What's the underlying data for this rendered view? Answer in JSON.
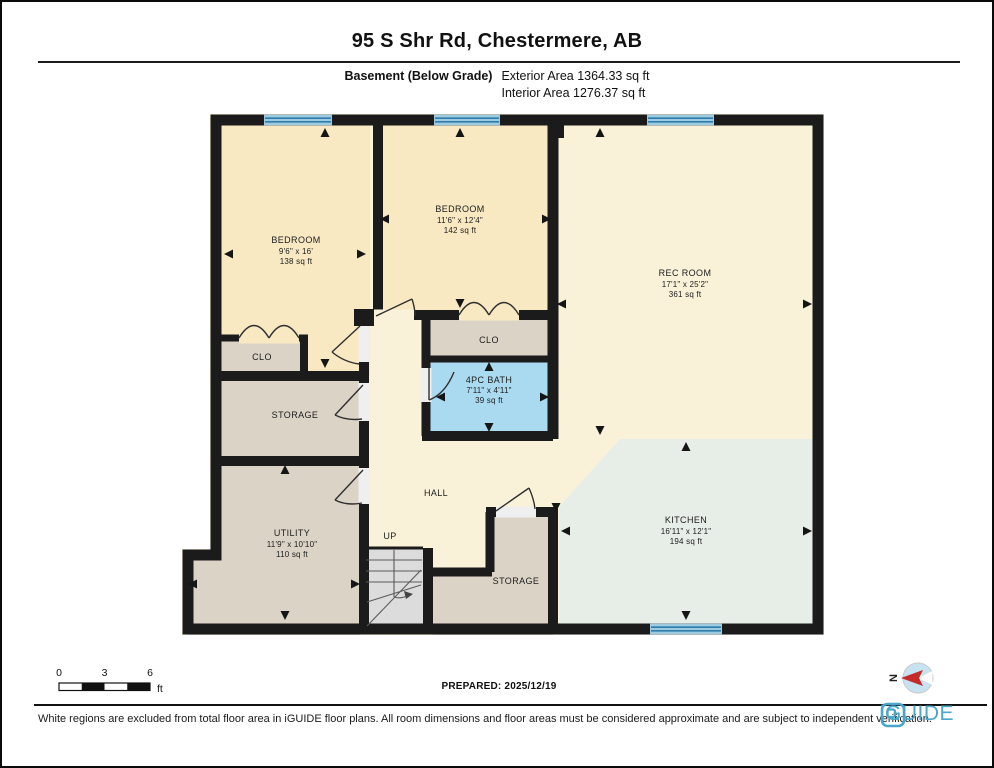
{
  "header": {
    "title": "95 S Shr Rd, Chestermere, AB",
    "floor": "Basement (Below Grade)",
    "exterior_area": "Exterior Area 1364.33 sq ft",
    "interior_area": "Interior Area 1276.37 sq ft"
  },
  "plan": {
    "rooms": {
      "bedroom1": {
        "name": "BEDROOM",
        "dims": "9'6\" x 16'",
        "area": "138 sq ft"
      },
      "bedroom2": {
        "name": "BEDROOM",
        "dims": "11'6\" x 12'4\"",
        "area": "142 sq ft"
      },
      "rec_room": {
        "name": "REC ROOM",
        "dims": "17'1\" x 25'2\"",
        "area": "361 sq ft"
      },
      "bath": {
        "name": "4PC BATH",
        "dims": "7'11\" x 4'11\"",
        "area": "39 sq ft"
      },
      "kitchen": {
        "name": "KITCHEN",
        "dims": "16'11\" x 12'1\"",
        "area": "194 sq ft"
      },
      "utility": {
        "name": "UTILITY",
        "dims": "11'9\" x 10'10\"",
        "area": "110 sq ft"
      },
      "storage_upper": {
        "name": "STORAGE"
      },
      "storage_lower": {
        "name": "STORAGE"
      },
      "clo_left": {
        "name": "CLO"
      },
      "clo_right": {
        "name": "CLO"
      },
      "hall": {
        "name": "HALL"
      },
      "up": {
        "name": "UP"
      }
    },
    "colors": {
      "floor": "#FAF1D9",
      "bedroom": "#F8E9C3",
      "storage": "#DBD3C6",
      "bath": "#A9DAF0",
      "kitchen": "#E7EDE7",
      "stairs": "#DCDCDC",
      "window": "#9FCBE0",
      "window_stripe": "#2E7EAD",
      "wall": "#1B1B1B",
      "brand_blue": "#4BA7C9",
      "compass_red": "#C62B2B"
    }
  },
  "scale_bar": {
    "tick0": "0",
    "tick1": "3",
    "tick2": "6",
    "unit": "ft"
  },
  "prepared": "PREPARED: 2025/12/19",
  "compass": {
    "north": "N"
  },
  "footer": {
    "disclaimer": "White regions are excluded from total floor area in iGUIDE floor plans. All room dimensions and floor areas must be considered approximate and are subject to independent verification.",
    "brand": "iGUIDE"
  }
}
